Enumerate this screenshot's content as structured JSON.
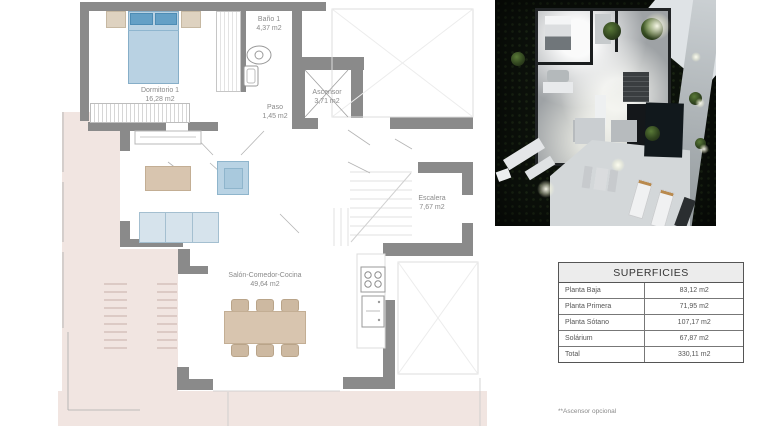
{
  "plan": {
    "rooms": [
      {
        "name": "Dormitorio 1",
        "area": "16,28 m2"
      },
      {
        "name": "Baño 1",
        "area": "4,37 m2"
      },
      {
        "name": "Paso",
        "area": "1,45 m2"
      },
      {
        "name": "Ascensor",
        "area": "3,71 m2"
      },
      {
        "name": "Escalera",
        "area": "7,67 m2"
      },
      {
        "name": "Salón-Comedor-Cocina",
        "area": "49,64 m2"
      }
    ]
  },
  "surfaces_table": {
    "title": "SUPERFICIES",
    "rows": [
      {
        "label": "Planta Baja",
        "value": "83,12 m2"
      },
      {
        "label": "Planta Primera",
        "value": "71,95 m2"
      },
      {
        "label": "Planta Sótano",
        "value": "107,17 m2"
      },
      {
        "label": "Solárium",
        "value": "67,87 m2"
      },
      {
        "label": "Total",
        "value": "330,11 m2"
      }
    ]
  },
  "footnote": "**Ascensor opcional",
  "colors": {
    "wall_gray": "#8a8a8a",
    "terrace_pink": "#f1e5e1",
    "furniture_wood": "#d8c5af",
    "furniture_blue": "#b9d2e3",
    "render_night_bg": "#0c110b"
  }
}
